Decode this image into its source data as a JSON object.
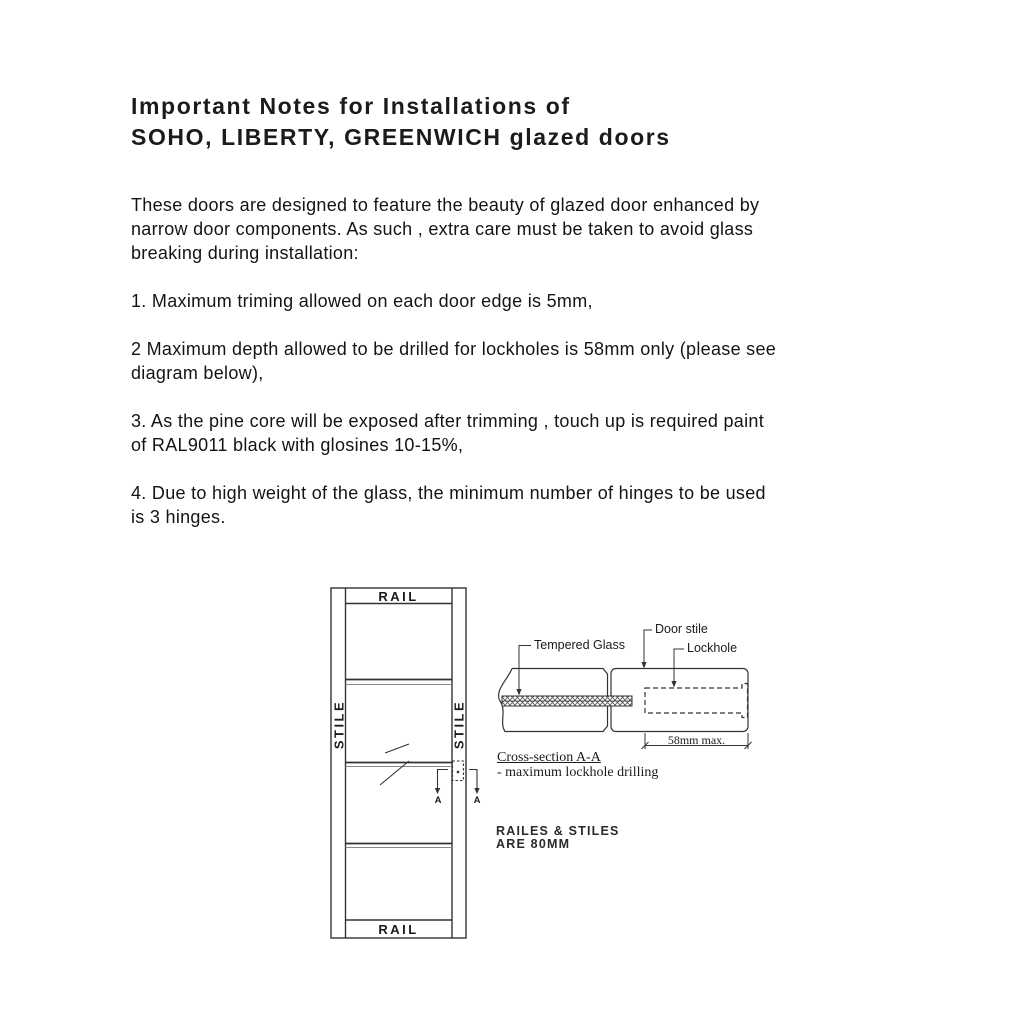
{
  "document": {
    "title": "Important Notes for Installations of\nSOHO, LIBERTY, GREENWICH glazed doors",
    "intro": "These doors are designed to feature the beauty of glazed door enhanced by\nnarrow door components. As such , extra care must be taken to avoid glass\nbreaking during installation:",
    "items": [
      "1. Maximum triming allowed on each door edge is 5mm,",
      "2 Maximum depth allowed to be drilled for lockholes is 58mm only (please see\ndiagram below),",
      "3. As the pine core will be exposed after trimming , touch up is required paint\nof RAL9011 black with glosines 10-15%,",
      "4. Due to high weight of the glass, the minimum number of hinges to be used\nis 3 hinges."
    ]
  },
  "diagram": {
    "door_elevation": {
      "rail_top": "RAIL",
      "rail_bottom": "RAIL",
      "stile_left": "STILE",
      "stile_right": "STILE",
      "section_marker_left": "A",
      "section_marker_right": "A"
    },
    "cross_section": {
      "label_tempered_glass": "Tempered Glass",
      "label_door_stile": "Door stile",
      "label_lockhole": "Lockhole",
      "dimension_max": "58mm max.",
      "caption_title": "Cross-section A-A",
      "caption_sub": "- maximum lockhole drilling"
    },
    "note": "RAILES & STILES\nARE 80MM"
  },
  "colors": {
    "background": "#ffffff",
    "text": "#1a1a1a",
    "line": "#333333"
  }
}
